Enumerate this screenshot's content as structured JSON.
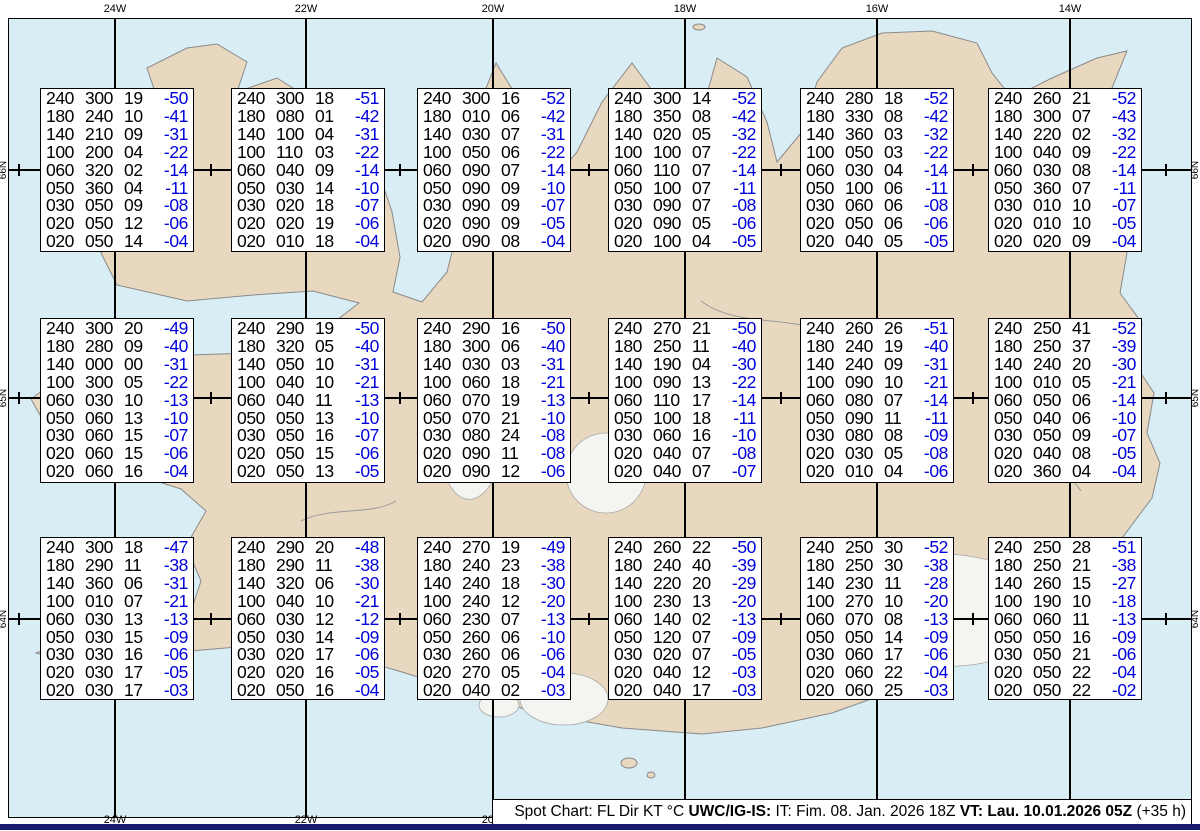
{
  "map": {
    "projection_labels": {
      "top": [
        "24W",
        "22W",
        "20W",
        "18W",
        "16W",
        "14W"
      ],
      "bottom": [
        "24W",
        "22W",
        "20W"
      ],
      "left": [
        "66N",
        "65N",
        "64N"
      ],
      "right": [
        "66N",
        "65N",
        "64N"
      ]
    }
  },
  "legend": {
    "prefix": "Spot Chart: FL Dir KT °C ",
    "model_bold": "UWC/IG-IS:",
    "issue_text": " IT: Fim. 08. Jan. 2026 18Z ",
    "valid_bold": "VT: Lau. 10.01.2026 05Z",
    "suffix": " (+35 h)"
  },
  "columns": [
    "FL",
    "Dir",
    "KT",
    "°C"
  ],
  "colors": {
    "ocean": "#d9edf5",
    "land": "#e8d8c0",
    "glacier": "#f4f4f1",
    "temp_text": "#0000dd",
    "footer_bar": "#1a1a70"
  },
  "spots": [
    {
      "rows": [
        [
          "240",
          "300",
          "19",
          "-50"
        ],
        [
          "180",
          "240",
          "10",
          "-41"
        ],
        [
          "140",
          "210",
          "09",
          "-31"
        ],
        [
          "100",
          "200",
          "04",
          "-22"
        ],
        [
          "060",
          "320",
          "02",
          "-14"
        ],
        [
          "050",
          "360",
          "04",
          "-11"
        ],
        [
          "030",
          "050",
          "09",
          "-08"
        ],
        [
          "020",
          "050",
          "12",
          "-06"
        ],
        [
          "020",
          "050",
          "14",
          "-04"
        ]
      ]
    },
    {
      "rows": [
        [
          "240",
          "300",
          "18",
          "-51"
        ],
        [
          "180",
          "080",
          "01",
          "-42"
        ],
        [
          "140",
          "100",
          "04",
          "-31"
        ],
        [
          "100",
          "110",
          "03",
          "-22"
        ],
        [
          "060",
          "040",
          "09",
          "-14"
        ],
        [
          "050",
          "030",
          "14",
          "-10"
        ],
        [
          "030",
          "020",
          "18",
          "-07"
        ],
        [
          "020",
          "020",
          "19",
          "-06"
        ],
        [
          "020",
          "010",
          "18",
          "-04"
        ]
      ]
    },
    {
      "rows": [
        [
          "240",
          "300",
          "16",
          "-52"
        ],
        [
          "180",
          "010",
          "06",
          "-42"
        ],
        [
          "140",
          "030",
          "07",
          "-31"
        ],
        [
          "100",
          "050",
          "06",
          "-22"
        ],
        [
          "060",
          "090",
          "07",
          "-14"
        ],
        [
          "050",
          "090",
          "09",
          "-10"
        ],
        [
          "030",
          "090",
          "09",
          "-07"
        ],
        [
          "020",
          "090",
          "09",
          "-05"
        ],
        [
          "020",
          "090",
          "08",
          "-04"
        ]
      ]
    },
    {
      "rows": [
        [
          "240",
          "300",
          "14",
          "-52"
        ],
        [
          "180",
          "350",
          "08",
          "-42"
        ],
        [
          "140",
          "020",
          "05",
          "-32"
        ],
        [
          "100",
          "100",
          "07",
          "-22"
        ],
        [
          "060",
          "110",
          "07",
          "-14"
        ],
        [
          "050",
          "100",
          "07",
          "-11"
        ],
        [
          "030",
          "090",
          "07",
          "-08"
        ],
        [
          "020",
          "090",
          "05",
          "-06"
        ],
        [
          "020",
          "100",
          "04",
          "-05"
        ]
      ]
    },
    {
      "rows": [
        [
          "240",
          "280",
          "18",
          "-52"
        ],
        [
          "180",
          "330",
          "08",
          "-42"
        ],
        [
          "140",
          "360",
          "03",
          "-32"
        ],
        [
          "100",
          "050",
          "03",
          "-22"
        ],
        [
          "060",
          "030",
          "04",
          "-14"
        ],
        [
          "050",
          "100",
          "06",
          "-11"
        ],
        [
          "030",
          "060",
          "06",
          "-08"
        ],
        [
          "020",
          "050",
          "06",
          "-06"
        ],
        [
          "020",
          "040",
          "05",
          "-05"
        ]
      ]
    },
    {
      "rows": [
        [
          "240",
          "260",
          "21",
          "-52"
        ],
        [
          "180",
          "300",
          "07",
          "-43"
        ],
        [
          "140",
          "220",
          "02",
          "-32"
        ],
        [
          "100",
          "040",
          "09",
          "-22"
        ],
        [
          "060",
          "030",
          "08",
          "-14"
        ],
        [
          "050",
          "360",
          "07",
          "-11"
        ],
        [
          "030",
          "010",
          "10",
          "-07"
        ],
        [
          "020",
          "010",
          "10",
          "-05"
        ],
        [
          "020",
          "020",
          "09",
          "-04"
        ]
      ]
    },
    {
      "rows": [
        [
          "240",
          "300",
          "20",
          "-49"
        ],
        [
          "180",
          "280",
          "09",
          "-40"
        ],
        [
          "140",
          "000",
          "00",
          "-31"
        ],
        [
          "100",
          "300",
          "05",
          "-22"
        ],
        [
          "060",
          "030",
          "10",
          "-13"
        ],
        [
          "050",
          "060",
          "13",
          "-10"
        ],
        [
          "030",
          "060",
          "15",
          "-07"
        ],
        [
          "020",
          "060",
          "15",
          "-06"
        ],
        [
          "020",
          "060",
          "16",
          "-04"
        ]
      ]
    },
    {
      "rows": [
        [
          "240",
          "290",
          "19",
          "-50"
        ],
        [
          "180",
          "320",
          "05",
          "-40"
        ],
        [
          "140",
          "050",
          "10",
          "-31"
        ],
        [
          "100",
          "040",
          "10",
          "-21"
        ],
        [
          "060",
          "040",
          "11",
          "-13"
        ],
        [
          "050",
          "050",
          "13",
          "-10"
        ],
        [
          "030",
          "050",
          "16",
          "-07"
        ],
        [
          "020",
          "050",
          "15",
          "-06"
        ],
        [
          "020",
          "050",
          "13",
          "-05"
        ]
      ]
    },
    {
      "rows": [
        [
          "240",
          "290",
          "16",
          "-50"
        ],
        [
          "180",
          "300",
          "06",
          "-40"
        ],
        [
          "140",
          "030",
          "03",
          "-31"
        ],
        [
          "100",
          "060",
          "18",
          "-21"
        ],
        [
          "060",
          "070",
          "19",
          "-13"
        ],
        [
          "050",
          "070",
          "21",
          "-10"
        ],
        [
          "030",
          "080",
          "24",
          "-08"
        ],
        [
          "020",
          "090",
          "11",
          "-08"
        ],
        [
          "020",
          "090",
          "12",
          "-06"
        ]
      ]
    },
    {
      "rows": [
        [
          "240",
          "270",
          "21",
          "-50"
        ],
        [
          "180",
          "250",
          "11",
          "-40"
        ],
        [
          "140",
          "190",
          "04",
          "-30"
        ],
        [
          "100",
          "090",
          "13",
          "-22"
        ],
        [
          "060",
          "110",
          "17",
          "-14"
        ],
        [
          "050",
          "100",
          "18",
          "-11"
        ],
        [
          "030",
          "060",
          "16",
          "-10"
        ],
        [
          "020",
          "040",
          "07",
          "-08"
        ],
        [
          "020",
          "040",
          "07",
          "-07"
        ]
      ]
    },
    {
      "rows": [
        [
          "240",
          "260",
          "26",
          "-51"
        ],
        [
          "180",
          "240",
          "19",
          "-40"
        ],
        [
          "140",
          "240",
          "09",
          "-31"
        ],
        [
          "100",
          "090",
          "10",
          "-21"
        ],
        [
          "060",
          "080",
          "07",
          "-14"
        ],
        [
          "050",
          "090",
          "11",
          "-11"
        ],
        [
          "030",
          "080",
          "08",
          "-09"
        ],
        [
          "020",
          "030",
          "05",
          "-08"
        ],
        [
          "020",
          "010",
          "04",
          "-06"
        ]
      ]
    },
    {
      "rows": [
        [
          "240",
          "250",
          "41",
          "-52"
        ],
        [
          "180",
          "250",
          "37",
          "-39"
        ],
        [
          "140",
          "240",
          "20",
          "-30"
        ],
        [
          "100",
          "010",
          "05",
          "-21"
        ],
        [
          "060",
          "050",
          "06",
          "-14"
        ],
        [
          "050",
          "040",
          "06",
          "-10"
        ],
        [
          "030",
          "050",
          "09",
          "-07"
        ],
        [
          "020",
          "040",
          "08",
          "-05"
        ],
        [
          "020",
          "360",
          "04",
          "-04"
        ]
      ]
    },
    {
      "rows": [
        [
          "240",
          "300",
          "18",
          "-47"
        ],
        [
          "180",
          "290",
          "11",
          "-38"
        ],
        [
          "140",
          "360",
          "06",
          "-31"
        ],
        [
          "100",
          "010",
          "07",
          "-21"
        ],
        [
          "060",
          "030",
          "13",
          "-13"
        ],
        [
          "050",
          "030",
          "15",
          "-09"
        ],
        [
          "030",
          "030",
          "16",
          "-06"
        ],
        [
          "020",
          "030",
          "17",
          "-05"
        ],
        [
          "020",
          "030",
          "17",
          "-03"
        ]
      ]
    },
    {
      "rows": [
        [
          "240",
          "290",
          "20",
          "-48"
        ],
        [
          "180",
          "290",
          "11",
          "-38"
        ],
        [
          "140",
          "320",
          "06",
          "-30"
        ],
        [
          "100",
          "040",
          "10",
          "-21"
        ],
        [
          "060",
          "030",
          "12",
          "-12"
        ],
        [
          "050",
          "030",
          "14",
          "-09"
        ],
        [
          "030",
          "020",
          "17",
          "-06"
        ],
        [
          "020",
          "020",
          "16",
          "-05"
        ],
        [
          "020",
          "050",
          "16",
          "-04"
        ]
      ]
    },
    {
      "rows": [
        [
          "240",
          "270",
          "19",
          "-49"
        ],
        [
          "180",
          "240",
          "23",
          "-38"
        ],
        [
          "140",
          "240",
          "18",
          "-30"
        ],
        [
          "100",
          "240",
          "12",
          "-20"
        ],
        [
          "060",
          "230",
          "07",
          "-13"
        ],
        [
          "050",
          "260",
          "06",
          "-10"
        ],
        [
          "030",
          "260",
          "06",
          "-06"
        ],
        [
          "020",
          "270",
          "05",
          "-04"
        ],
        [
          "020",
          "040",
          "02",
          "-03"
        ]
      ]
    },
    {
      "rows": [
        [
          "240",
          "260",
          "22",
          "-50"
        ],
        [
          "180",
          "240",
          "40",
          "-39"
        ],
        [
          "140",
          "220",
          "20",
          "-29"
        ],
        [
          "100",
          "230",
          "13",
          "-20"
        ],
        [
          "060",
          "140",
          "02",
          "-13"
        ],
        [
          "050",
          "120",
          "07",
          "-09"
        ],
        [
          "030",
          "020",
          "07",
          "-05"
        ],
        [
          "020",
          "040",
          "12",
          "-03"
        ],
        [
          "020",
          "040",
          "17",
          "-03"
        ]
      ]
    },
    {
      "rows": [
        [
          "240",
          "250",
          "30",
          "-52"
        ],
        [
          "180",
          "250",
          "30",
          "-38"
        ],
        [
          "140",
          "230",
          "11",
          "-28"
        ],
        [
          "100",
          "270",
          "10",
          "-20"
        ],
        [
          "060",
          "070",
          "08",
          "-13"
        ],
        [
          "050",
          "050",
          "14",
          "-09"
        ],
        [
          "030",
          "060",
          "17",
          "-06"
        ],
        [
          "020",
          "060",
          "22",
          "-04"
        ],
        [
          "020",
          "060",
          "25",
          "-03"
        ]
      ]
    },
    {
      "rows": [
        [
          "240",
          "250",
          "28",
          "-51"
        ],
        [
          "180",
          "250",
          "21",
          "-38"
        ],
        [
          "140",
          "260",
          "15",
          "-27"
        ],
        [
          "100",
          "190",
          "10",
          "-18"
        ],
        [
          "060",
          "060",
          "11",
          "-13"
        ],
        [
          "050",
          "050",
          "16",
          "-09"
        ],
        [
          "030",
          "050",
          "21",
          "-06"
        ],
        [
          "020",
          "050",
          "22",
          "-04"
        ],
        [
          "020",
          "050",
          "22",
          "-02"
        ]
      ]
    }
  ]
}
